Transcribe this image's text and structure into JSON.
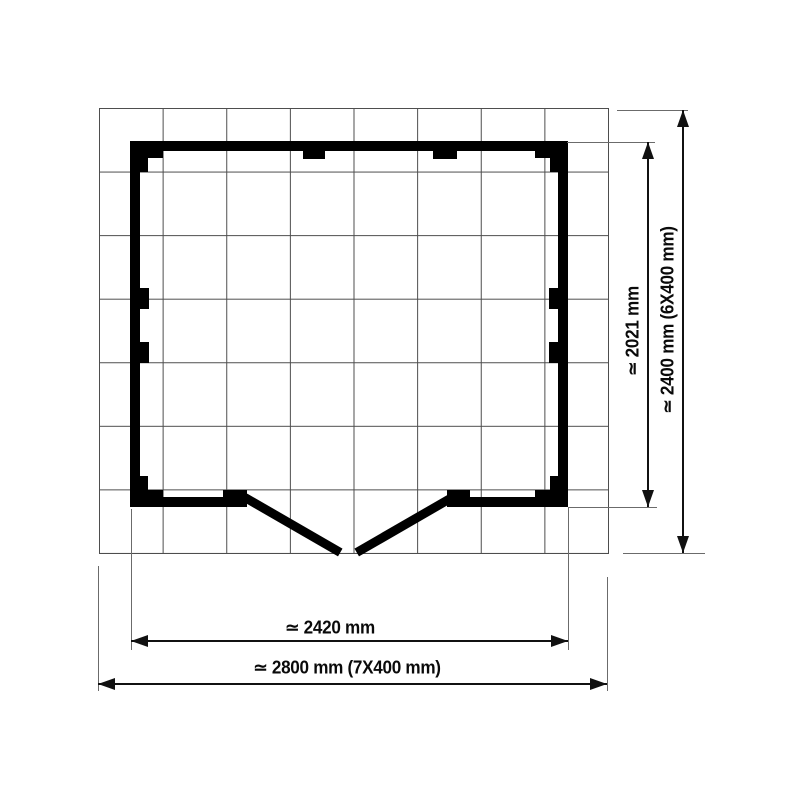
{
  "diagram": {
    "type": "floor-plan",
    "grid": {
      "columns": 8,
      "rows": 7,
      "cell_label": "400 mm"
    },
    "dimensions": {
      "inner_depth": {
        "label": "≃ 2021 mm",
        "value_mm": 2021,
        "orientation": "vertical"
      },
      "outer_depth": {
        "label": "≃ 2400 mm (6X400 mm)",
        "value_mm": 2400,
        "orientation": "vertical"
      },
      "inner_width": {
        "label": "≃ 2420 mm",
        "value_mm": 2420,
        "orientation": "horizontal"
      },
      "outer_width": {
        "label": "≃ 2800 mm (7X400 mm)",
        "value_mm": 2800,
        "orientation": "horizontal"
      }
    },
    "features": {
      "doors": "double doors at bottom, shown open outward meeting at center",
      "stud_tabs": 6,
      "corner_posts": 4
    },
    "colors": {
      "background": "#ffffff",
      "wall": "#000000",
      "grid_line": "#4d4d4d",
      "extension_line": "#6b6b6b",
      "dimension_line": "#111111",
      "text": "#0a0a0a"
    }
  }
}
